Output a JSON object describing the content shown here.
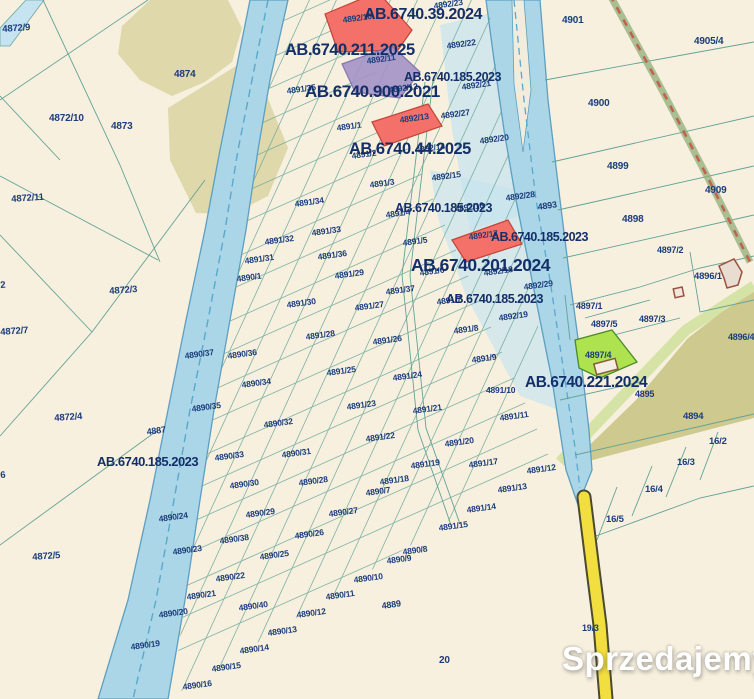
{
  "site": {
    "watermark": {
      "text": "Sprzedajemy",
      "tld": ".pl"
    }
  },
  "map": {
    "background_color": "#f7f0df",
    "colors": {
      "parcel_line": "#63a295",
      "label_text": "#1b3d7c",
      "permit_text": "#142f68",
      "river_fill": "#aad6e8",
      "river_edge": "#5d9fc0",
      "flood_overlay": "#c5e3f0",
      "forest": "#ded8ab",
      "olive_area": "#cdc98f",
      "green_parcel": "#aee34f",
      "red_parcel": "#f4716a",
      "purple_parcel": "#a393c8",
      "road_yellow": "#f2de3f",
      "railway_dash": "#c0614f",
      "watermark_badge": "#de3a2d"
    },
    "permit_labels": [
      {
        "t": "AB.6740.39.2024",
        "x": 364,
        "y": 6,
        "s": 16
      },
      {
        "t": "AB.6740.211.2025",
        "x": 285,
        "y": 41,
        "s": 16.5
      },
      {
        "t": "AB.6740.185.2023",
        "x": 404,
        "y": 70,
        "s": 12.5
      },
      {
        "t": "AB.6740.900.2021",
        "x": 305,
        "y": 82,
        "s": 17
      },
      {
        "t": "AB.6740.44.2025",
        "x": 349,
        "y": 140,
        "s": 16.5
      },
      {
        "t": "AB.6740.185.2023",
        "x": 395,
        "y": 201,
        "s": 12.5
      },
      {
        "t": "AB.6740.185.2023",
        "x": 491,
        "y": 230,
        "s": 12.5
      },
      {
        "t": "AB.6740.201.2024",
        "x": 411,
        "y": 255,
        "s": 17.5
      },
      {
        "t": "AB.6740.185.2023",
        "x": 446,
        "y": 292,
        "s": 12.5
      },
      {
        "t": "AB.6740.221.2024",
        "x": 525,
        "y": 374,
        "s": 15.5
      },
      {
        "t": "AB.6740.185.2023",
        "x": 97,
        "y": 454,
        "s": 13
      }
    ],
    "parcel_labels": [
      {
        "t": "4872/9",
        "x": 2,
        "y": 24,
        "r": -4,
        "s": 9.5
      },
      {
        "t": "4874",
        "x": 174,
        "y": 69,
        "r": 0,
        "s": 10
      },
      {
        "t": "4872/10",
        "x": 49,
        "y": 113,
        "r": 0,
        "s": 10
      },
      {
        "t": "4873",
        "x": 111,
        "y": 121,
        "r": 0,
        "s": 10
      },
      {
        "t": "4872/11",
        "x": 11,
        "y": 194,
        "r": -4,
        "s": 9.5
      },
      {
        "t": "2",
        "x": 0,
        "y": 280,
        "r": -4,
        "s": 9.5
      },
      {
        "t": "4872/3",
        "x": 109,
        "y": 286,
        "r": -4,
        "s": 9.5
      },
      {
        "t": "4872/7",
        "x": 0,
        "y": 327,
        "r": -4,
        "s": 9.5
      },
      {
        "t": "4872/4",
        "x": 54,
        "y": 413,
        "r": -4,
        "s": 9.5
      },
      {
        "t": "4887",
        "x": 146,
        "y": 427,
        "r": -8,
        "s": 9
      },
      {
        "t": "6",
        "x": 0,
        "y": 470,
        "r": -4,
        "s": 9.5
      },
      {
        "t": "4872/5",
        "x": 32,
        "y": 552,
        "r": -4,
        "s": 9.5
      },
      {
        "t": "4890/1",
        "x": 236,
        "y": 274,
        "r": -8,
        "s": 8.5
      },
      {
        "t": "4890/37",
        "x": 184,
        "y": 351,
        "r": -8,
        "s": 8.5
      },
      {
        "t": "4890/36",
        "x": 227,
        "y": 351,
        "r": -8,
        "s": 8.5
      },
      {
        "t": "4890/34",
        "x": 241,
        "y": 380,
        "r": -8,
        "s": 8.5
      },
      {
        "t": "4890/35",
        "x": 191,
        "y": 404,
        "r": -8,
        "s": 8.5
      },
      {
        "t": "4890/33",
        "x": 214,
        "y": 453,
        "r": -8,
        "s": 8.5
      },
      {
        "t": "4890/32",
        "x": 263,
        "y": 420,
        "r": -8,
        "s": 8.5
      },
      {
        "t": "4890/31",
        "x": 281,
        "y": 450,
        "r": -8,
        "s": 8.5
      },
      {
        "t": "4890/30",
        "x": 229,
        "y": 481,
        "r": -8,
        "s": 8.5
      },
      {
        "t": "4890/29",
        "x": 245,
        "y": 510,
        "r": -8,
        "s": 8.5
      },
      {
        "t": "4890/28",
        "x": 298,
        "y": 478,
        "r": -8,
        "s": 8.5
      },
      {
        "t": "4890/27",
        "x": 328,
        "y": 509,
        "r": -8,
        "s": 8.5
      },
      {
        "t": "4890/26",
        "x": 294,
        "y": 531,
        "r": -8,
        "s": 8.5
      },
      {
        "t": "4890/25",
        "x": 259,
        "y": 552,
        "r": -8,
        "s": 8.5
      },
      {
        "t": "4890/24",
        "x": 158,
        "y": 514,
        "r": -8,
        "s": 8.5
      },
      {
        "t": "4890/23",
        "x": 172,
        "y": 547,
        "r": -8,
        "s": 8.5
      },
      {
        "t": "4890/38",
        "x": 219,
        "y": 536,
        "r": -8,
        "s": 8.5
      },
      {
        "t": "4890/22",
        "x": 215,
        "y": 574,
        "r": -8,
        "s": 8.5
      },
      {
        "t": "4890/21",
        "x": 186,
        "y": 592,
        "r": -8,
        "s": 8.5
      },
      {
        "t": "4890/20",
        "x": 158,
        "y": 610,
        "r": -8,
        "s": 8.5
      },
      {
        "t": "4890/19",
        "x": 130,
        "y": 642,
        "r": -8,
        "s": 8.5
      },
      {
        "t": "4890/15",
        "x": 211,
        "y": 664,
        "r": -8,
        "s": 8.5
      },
      {
        "t": "4890/16",
        "x": 182,
        "y": 682,
        "r": -8,
        "s": 8.5
      },
      {
        "t": "4890/40",
        "x": 238,
        "y": 603,
        "r": -8,
        "s": 8.5
      },
      {
        "t": "4890/12",
        "x": 296,
        "y": 610,
        "r": -8,
        "s": 8.5
      },
      {
        "t": "4890/13",
        "x": 267,
        "y": 628,
        "r": -8,
        "s": 8.5
      },
      {
        "t": "4890/14",
        "x": 239,
        "y": 646,
        "r": -8,
        "s": 8.5
      },
      {
        "t": "4890/11",
        "x": 325,
        "y": 592,
        "r": -8,
        "s": 8.5
      },
      {
        "t": "4890/10",
        "x": 353,
        "y": 575,
        "r": -8,
        "s": 8.5
      },
      {
        "t": "4890/9",
        "x": 386,
        "y": 556,
        "r": -8,
        "s": 8.5
      },
      {
        "t": "4890/8",
        "x": 402,
        "y": 547,
        "r": -8,
        "s": 8.5
      },
      {
        "t": "4890/7",
        "x": 365,
        "y": 488,
        "r": -8,
        "s": 8.5
      },
      {
        "t": "4889",
        "x": 381,
        "y": 601,
        "r": -8,
        "s": 9
      },
      {
        "t": "20",
        "x": 439,
        "y": 655,
        "r": 0,
        "s": 10
      },
      {
        "t": "19/3",
        "x": 582,
        "y": 623,
        "r": 0,
        "s": 9
      },
      {
        "t": "4891/35",
        "x": 286,
        "y": 86,
        "r": -8,
        "s": 8.5
      },
      {
        "t": "4891/1",
        "x": 336,
        "y": 123,
        "r": -8,
        "s": 8.5
      },
      {
        "t": "4891/2",
        "x": 351,
        "y": 151,
        "r": -8,
        "s": 8.5
      },
      {
        "t": "4891/3",
        "x": 369,
        "y": 180,
        "r": -8,
        "s": 8.5
      },
      {
        "t": "4891/34",
        "x": 294,
        "y": 199,
        "r": -8,
        "s": 8.5
      },
      {
        "t": "4891/33",
        "x": 311,
        "y": 228,
        "r": -8,
        "s": 8.5
      },
      {
        "t": "4891/32",
        "x": 264,
        "y": 237,
        "r": -8,
        "s": 8.5
      },
      {
        "t": "4891/31",
        "x": 244,
        "y": 256,
        "r": -8,
        "s": 8.5
      },
      {
        "t": "4891/36",
        "x": 317,
        "y": 252,
        "r": -8,
        "s": 8.5
      },
      {
        "t": "4891/29",
        "x": 334,
        "y": 271,
        "r": -8,
        "s": 8.5
      },
      {
        "t": "4891/30",
        "x": 286,
        "y": 300,
        "r": -8,
        "s": 8.5
      },
      {
        "t": "4891/28",
        "x": 305,
        "y": 332,
        "r": -8,
        "s": 8.5
      },
      {
        "t": "4891/27",
        "x": 354,
        "y": 303,
        "r": -8,
        "s": 8.5
      },
      {
        "t": "4891/26",
        "x": 372,
        "y": 337,
        "r": -8,
        "s": 8.5
      },
      {
        "t": "4891/25",
        "x": 326,
        "y": 368,
        "r": -8,
        "s": 8.5
      },
      {
        "t": "4891/24",
        "x": 392,
        "y": 373,
        "r": -8,
        "s": 8.5
      },
      {
        "t": "4891/23",
        "x": 346,
        "y": 402,
        "r": -8,
        "s": 8.5
      },
      {
        "t": "4891/22",
        "x": 365,
        "y": 434,
        "r": -8,
        "s": 8.5
      },
      {
        "t": "4891/21",
        "x": 412,
        "y": 406,
        "r": -8,
        "s": 8.5
      },
      {
        "t": "4891/20",
        "x": 444,
        "y": 439,
        "r": -8,
        "s": 8.5
      },
      {
        "t": "4891/19",
        "x": 410,
        "y": 461,
        "r": -8,
        "s": 8.5
      },
      {
        "t": "4891/18",
        "x": 379,
        "y": 477,
        "r": -8,
        "s": 8.5
      },
      {
        "t": "4891/17",
        "x": 468,
        "y": 460,
        "r": -8,
        "s": 8.5
      },
      {
        "t": "4891/15",
        "x": 438,
        "y": 523,
        "r": -8,
        "s": 8.5
      },
      {
        "t": "4891/14",
        "x": 466,
        "y": 505,
        "r": -8,
        "s": 8.5
      },
      {
        "t": "4891/13",
        "x": 497,
        "y": 485,
        "r": -8,
        "s": 8.5
      },
      {
        "t": "4891/12",
        "x": 526,
        "y": 466,
        "r": -8,
        "s": 8.5
      },
      {
        "t": "4891/11",
        "x": 499,
        "y": 413,
        "r": -8,
        "s": 8.5
      },
      {
        "t": "4891/10",
        "x": 486,
        "y": 385,
        "r": 0,
        "s": 8.5
      },
      {
        "t": "4891/9",
        "x": 471,
        "y": 355,
        "r": -8,
        "s": 8.5
      },
      {
        "t": "4891/8",
        "x": 453,
        "y": 326,
        "r": -8,
        "s": 8.5
      },
      {
        "t": "4891/7",
        "x": 436,
        "y": 297,
        "r": -8,
        "s": 8.5
      },
      {
        "t": "4891/37",
        "x": 385,
        "y": 287,
        "r": -8,
        "s": 8.5
      },
      {
        "t": "4891/6",
        "x": 419,
        "y": 268,
        "r": -8,
        "s": 8.5
      },
      {
        "t": "4891/5",
        "x": 402,
        "y": 238,
        "r": -8,
        "s": 8.5
      },
      {
        "t": "4891/4",
        "x": 385,
        "y": 210,
        "r": -8,
        "s": 8.5
      },
      {
        "t": "4892/23",
        "x": 433,
        "y": 1,
        "r": -8,
        "s": 8.5
      },
      {
        "t": "4892/10",
        "x": 342,
        "y": 15,
        "r": -8,
        "s": 8.5
      },
      {
        "t": "4892/22",
        "x": 446,
        "y": 41,
        "r": -8,
        "s": 8.5
      },
      {
        "t": "4892/11",
        "x": 366,
        "y": 56,
        "r": -8,
        "s": 8.5
      },
      {
        "t": "4892/21",
        "x": 461,
        "y": 82,
        "r": -8,
        "s": 8.5
      },
      {
        "t": "4892/12",
        "x": 388,
        "y": 85,
        "r": -8,
        "s": 8.5
      },
      {
        "t": "4892/27",
        "x": 440,
        "y": 111,
        "r": -8,
        "s": 8.5
      },
      {
        "t": "4892/13",
        "x": 399,
        "y": 115,
        "r": -8,
        "s": 8.5
      },
      {
        "t": "4892/20",
        "x": 479,
        "y": 136,
        "r": -8,
        "s": 8.5
      },
      {
        "t": "4892/14",
        "x": 415,
        "y": 145,
        "r": -8,
        "s": 8.5
      },
      {
        "t": "4892/15",
        "x": 431,
        "y": 173,
        "r": -8,
        "s": 8.5
      },
      {
        "t": "4892/28",
        "x": 505,
        "y": 193,
        "r": -8,
        "s": 8.5
      },
      {
        "t": "4893",
        "x": 537,
        "y": 202,
        "r": -8,
        "s": 9
      },
      {
        "t": "4892/16",
        "x": 454,
        "y": 204,
        "r": -8,
        "s": 8.5
      },
      {
        "t": "4892/17",
        "x": 468,
        "y": 232,
        "r": -8,
        "s": 8.5
      },
      {
        "t": "4892/18",
        "x": 483,
        "y": 268,
        "r": -8,
        "s": 8.5
      },
      {
        "t": "4892/29",
        "x": 523,
        "y": 282,
        "r": -8,
        "s": 8.5
      },
      {
        "t": "4892/19",
        "x": 498,
        "y": 313,
        "r": -8,
        "s": 8.5
      },
      {
        "t": "4901",
        "x": 562,
        "y": 15,
        "r": 0,
        "s": 10
      },
      {
        "t": "4905/4",
        "x": 694,
        "y": 36,
        "r": 0,
        "s": 10
      },
      {
        "t": "4900",
        "x": 588,
        "y": 98,
        "r": 0,
        "s": 10
      },
      {
        "t": "4899",
        "x": 607,
        "y": 161,
        "r": 0,
        "s": 10
      },
      {
        "t": "4909",
        "x": 705,
        "y": 185,
        "r": 0,
        "s": 10
      },
      {
        "t": "4898",
        "x": 622,
        "y": 214,
        "r": 0,
        "s": 10
      },
      {
        "t": "4897/2",
        "x": 657,
        "y": 245,
        "r": 0,
        "s": 9
      },
      {
        "t": "4896/1",
        "x": 694,
        "y": 271,
        "r": 0,
        "s": 9.5
      },
      {
        "t": "4897/1",
        "x": 576,
        "y": 301,
        "r": 0,
        "s": 9
      },
      {
        "t": "4897/5",
        "x": 591,
        "y": 319,
        "r": 0,
        "s": 9
      },
      {
        "t": "4897/3",
        "x": 639,
        "y": 314,
        "r": 0,
        "s": 9
      },
      {
        "t": "4897/4",
        "x": 585,
        "y": 350,
        "r": 0,
        "s": 9
      },
      {
        "t": "4896/4",
        "x": 728,
        "y": 332,
        "r": 0,
        "s": 9
      },
      {
        "t": "4895",
        "x": 635,
        "y": 389,
        "r": 0,
        "s": 9
      },
      {
        "t": "4894",
        "x": 683,
        "y": 411,
        "r": 0,
        "s": 9.5
      },
      {
        "t": "16/2",
        "x": 709,
        "y": 436,
        "r": 0,
        "s": 9.5
      },
      {
        "t": "16/3",
        "x": 677,
        "y": 457,
        "r": 0,
        "s": 9.5
      },
      {
        "t": "16/4",
        "x": 645,
        "y": 484,
        "r": 0,
        "s": 9.5
      },
      {
        "t": "16/5",
        "x": 606,
        "y": 514,
        "r": 0,
        "s": 9.5
      }
    ]
  }
}
